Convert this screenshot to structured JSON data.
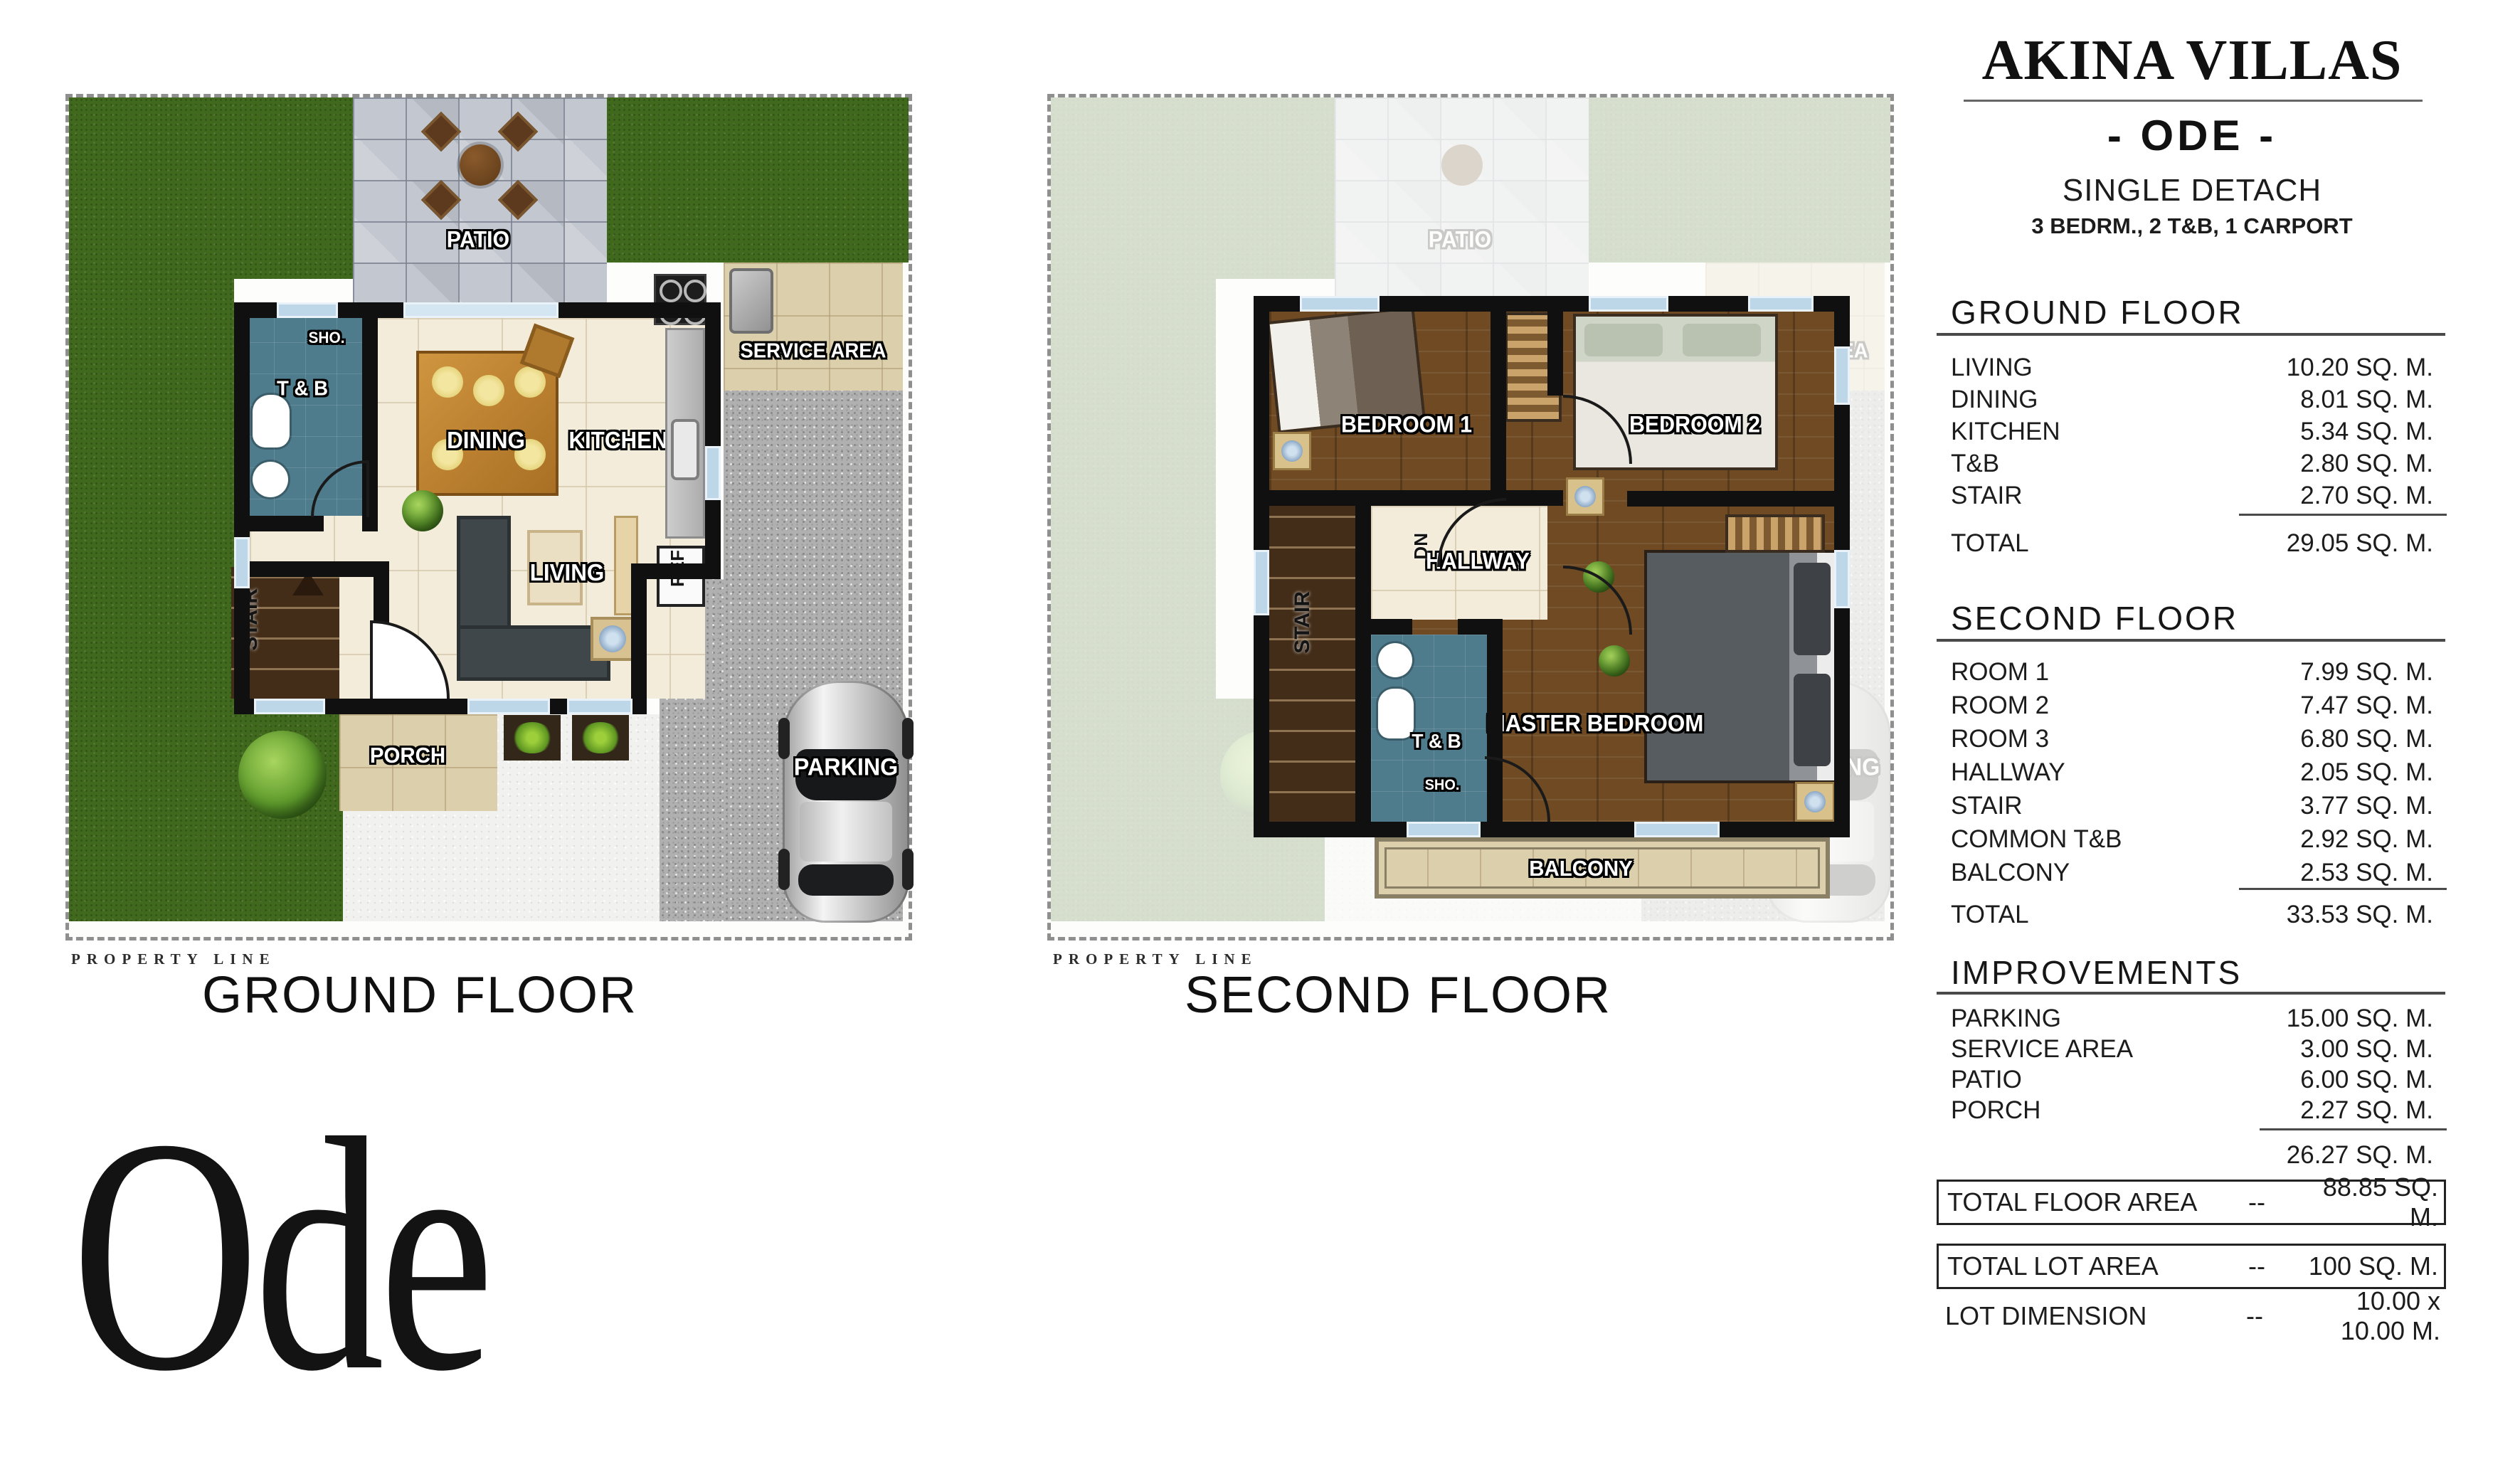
{
  "panel": {
    "brand": "AKINA VILLAS",
    "model": "- ODE -",
    "type": "SINGLE DETACH",
    "spec": "3 BEDRM., 2 T&B, 1 CARPORT",
    "ground": {
      "title": "GROUND FLOOR",
      "rows": [
        {
          "label": "LIVING",
          "value": "10.20 SQ. M."
        },
        {
          "label": "DINING",
          "value": "8.01 SQ. M."
        },
        {
          "label": "KITCHEN",
          "value": "5.34 SQ. M."
        },
        {
          "label": "T&B",
          "value": "2.80 SQ. M."
        },
        {
          "label": "STAIR",
          "value": "2.70 SQ. M."
        }
      ],
      "total_label": "TOTAL",
      "total_value": "29.05 SQ. M."
    },
    "second": {
      "title": "SECOND FLOOR",
      "rows": [
        {
          "label": "ROOM 1",
          "value": "7.99 SQ. M."
        },
        {
          "label": "ROOM 2",
          "value": "7.47 SQ. M."
        },
        {
          "label": "ROOM 3",
          "value": "6.80 SQ. M."
        },
        {
          "label": "HALLWAY",
          "value": "2.05 SQ. M."
        },
        {
          "label": "STAIR",
          "value": "3.77 SQ. M."
        },
        {
          "label": "COMMON T&B",
          "value": "2.92 SQ. M."
        },
        {
          "label": "BALCONY",
          "value": "2.53 SQ. M."
        }
      ],
      "total_label": "TOTAL",
      "total_value": "33.53 SQ. M."
    },
    "improvements": {
      "title": "IMPROVEMENTS",
      "rows": [
        {
          "label": "PARKING",
          "value": "15.00 SQ. M."
        },
        {
          "label": "SERVICE AREA",
          "value": "3.00 SQ. M."
        },
        {
          "label": "PATIO",
          "value": "6.00 SQ. M."
        },
        {
          "label": "PORCH",
          "value": "2.27 SQ. M."
        }
      ],
      "subtotal_value": "26.27 SQ. M."
    },
    "totals": {
      "floor_area_label": "TOTAL FLOOR AREA",
      "floor_area_dash": "--",
      "floor_area_value": "88.85 SQ. M.",
      "lot_area_label": "TOTAL LOT AREA",
      "lot_area_dash": "--",
      "lot_area_value": "100 SQ. M.",
      "lot_dim_label": "LOT DIMENSION",
      "lot_dim_dash": "--",
      "lot_dim_value": "10.00 x 10.00 M."
    }
  },
  "ground_plan": {
    "caption": "GROUND FLOOR",
    "property_line": "PROPERTY LINE",
    "labels": {
      "patio": "PATIO",
      "sho": "SHO.",
      "tnb": "T & B",
      "dining": "DINING",
      "kitchen": "KITCHEN",
      "service": "SERVICE AREA",
      "ref": "REF",
      "living": "LIVING",
      "stair": "STAIR",
      "porch": "PORCH",
      "parking": "PARKING"
    }
  },
  "second_plan": {
    "caption": "SECOND FLOOR",
    "property_line": "PROPERTY LINE",
    "labels": {
      "bedroom1": "BEDROOM 1",
      "bedroom2": "BEDROOM 2",
      "hallway": "HALLWAY",
      "dn": "DN",
      "stair": "STAIR",
      "tnb": "T & B",
      "sho": "SHO.",
      "master": "MASTER BEDROOM",
      "balcony": "BALCONY"
    },
    "ghost": {
      "patio": "PATIO",
      "service": "SERVICE AREA",
      "parking": "PARKING"
    }
  },
  "model_name": "Ode",
  "colors": {
    "grass": "#41691d",
    "teal_bath": "#4e7c8c",
    "wood_floor": "#6f4a22",
    "tan_tile": "#dccfab",
    "gravel": "#b0b0b0",
    "wall": "#101010",
    "text": "#1c1c1c"
  }
}
